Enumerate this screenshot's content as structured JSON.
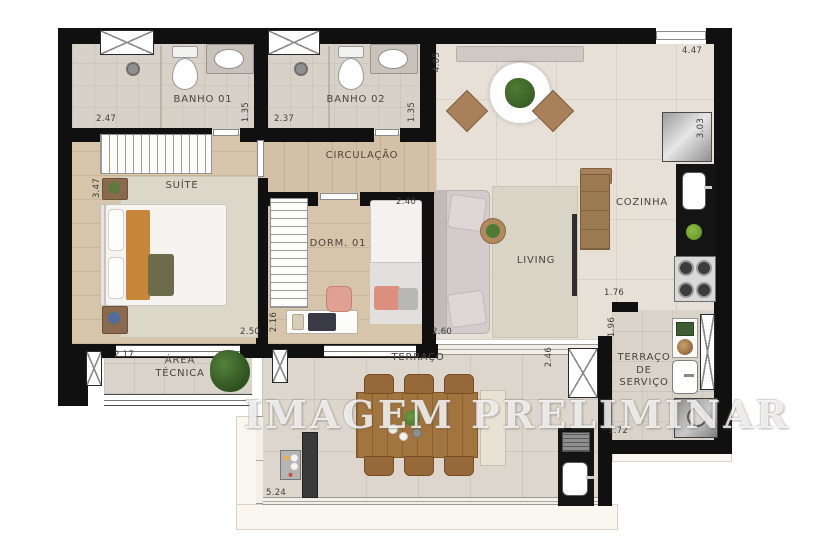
{
  "watermark": "IMAGEM PRELIMINAR",
  "rooms": {
    "banho01": "BANHO 01",
    "banho02": "BANHO 02",
    "circulacao": "CIRCULAÇÃO",
    "suite": "SUÍTE",
    "dorm01": "DORM. 01",
    "living": "LIVING",
    "cozinha": "COZINHA",
    "area_tecnica": "ÁREA\nTÉCNICA",
    "terraco": "TERRAÇO",
    "terraco_servico": "TERRAÇO\nDE\nSERVIÇO"
  },
  "dims": {
    "banho01_width": "2.47",
    "banho01_depth": "1.35",
    "banho02_width": "2.37",
    "banho02_depth": "1.35",
    "living_depth": "4.65",
    "entry_width": "4.47",
    "cozinha_depth": "3.03",
    "suite_depth": "3.47",
    "suite_width": "2.50",
    "dorm01_width": "2.40",
    "dorm01_depth": "2.16",
    "living_width": "2.60",
    "cozinha_width": "1.76",
    "cozinha_side": "1.96",
    "area_tecnica_width": "2.17",
    "terraco_depth": "2.46",
    "terraco_width": "5.24",
    "servico_width": "1.72"
  },
  "colors": {
    "wall": "#101010",
    "wood_floor": "#d2c1a7",
    "tile_floor": "#e6e0d7",
    "accent_wood": "#a3753e",
    "counter_black": "#141414"
  }
}
